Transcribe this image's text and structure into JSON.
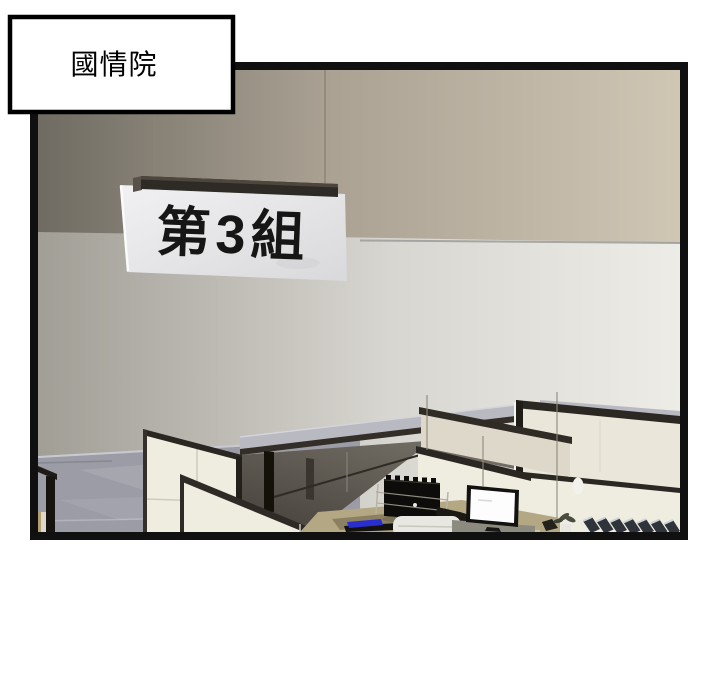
{
  "panel": {
    "caption": "國情院",
    "sign_text": "第3組"
  },
  "colors": {
    "margin": "#ffffff",
    "frame": "#101010",
    "caption_bg": "#ffffff",
    "caption_border": "#000000",
    "upper_wall_left": "#6f6b62",
    "upper_wall_right": "#d0c6b4",
    "lower_wall_left": "#a19e96",
    "lower_wall_right": "#edece7",
    "sign_board": "#ededef",
    "sign_bar": "#2e2a25",
    "granite": "#9c9ca6",
    "counter_granite": "#b9b9c1",
    "cubicle_cream": "#efece0",
    "cubicle_cream_shaded": "#ddd8ca",
    "dark_rail": "#2a2622",
    "interior_shadow": "#6e6961",
    "desk_khaki": "#b3a883",
    "crate_black": "#0d0c0a",
    "chair_white": "#e9e7e1",
    "monitor_frame": "#131210",
    "monitor_screen": "#fdfdfd",
    "binder_dark": "#2f343a",
    "binder_light": "#cdd2d6",
    "blue_folder": "#2a2ecc",
    "tan_object": "#b49f6e",
    "wire": "#8a8477"
  }
}
